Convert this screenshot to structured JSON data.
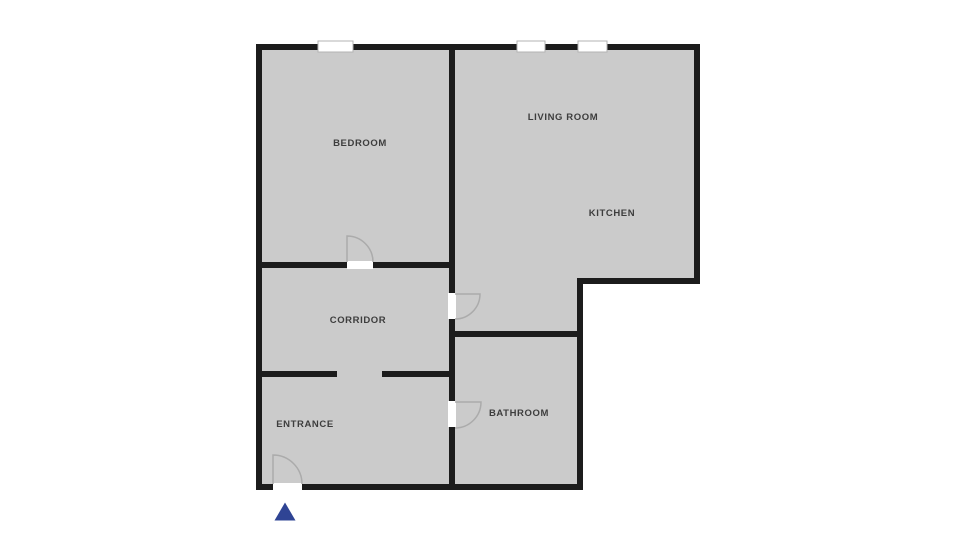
{
  "floor_plan": {
    "colors": {
      "background": "#ffffff",
      "floor": "#cbcbcb",
      "walls": "#1c1c1c",
      "door_swing": "#ababab",
      "window_fill": "#ffffff",
      "label_text": "#3d3d3d",
      "entrance_marker": "#2f4494"
    },
    "rooms": [
      {
        "id": "bedroom",
        "label": "BEDROOM"
      },
      {
        "id": "living_room",
        "label": "LIVING ROOM"
      },
      {
        "id": "kitchen",
        "label": "KITCHEN"
      },
      {
        "id": "corridor",
        "label": "CORRIDOR"
      },
      {
        "id": "bathroom",
        "label": "BATHROOM"
      },
      {
        "id": "entrance",
        "label": "ENTRANCE"
      }
    ],
    "window_count": 3,
    "door_count": 4,
    "entrance_marker_shape": "triangle-up"
  }
}
